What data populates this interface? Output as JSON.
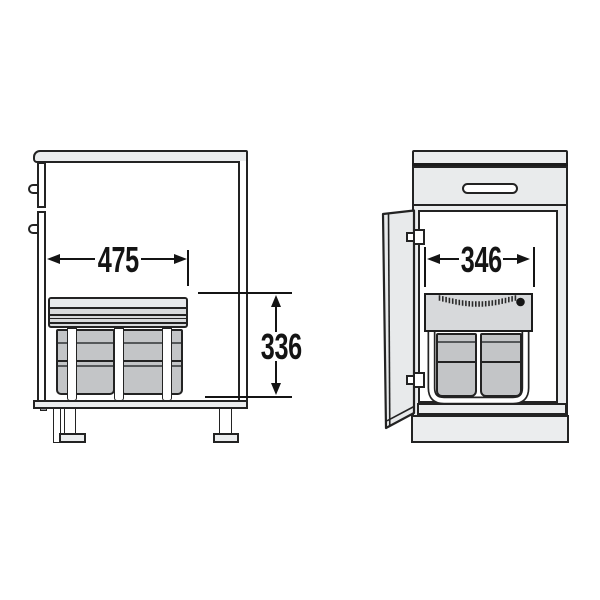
{
  "diagram": {
    "description": "Technical installation drawing of built-in waste bin units in two base cabinets",
    "dimensions": {
      "unit_depth": "475",
      "unit_height": "336",
      "unit_width": "346"
    },
    "colors": {
      "line": "#232323",
      "dimension": "#141414",
      "panel_fill": "#ebedee",
      "lid_fill": "#d8dadc",
      "bin_fill": "#c3c5c7"
    }
  }
}
